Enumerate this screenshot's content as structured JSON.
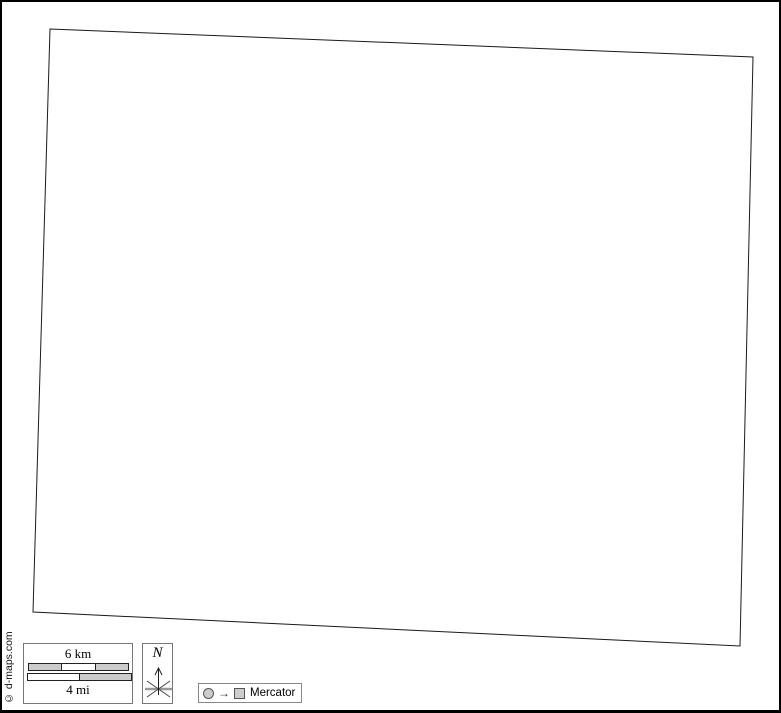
{
  "map": {
    "description": "blank map outline",
    "fill": "#ffffff",
    "stroke": "#1a1a1a",
    "corners": [
      [
        50,
        29
      ],
      [
        753,
        57
      ],
      [
        740,
        646
      ],
      [
        33,
        612
      ]
    ]
  },
  "scale_bar": {
    "km_label": "6 km",
    "mi_label": "4 mi",
    "km_segments": [
      "#cccccc",
      "#ffffff",
      "#cccccc"
    ],
    "mi_segments": [
      "#ffffff",
      "#cccccc"
    ]
  },
  "compass": {
    "north_label": "N"
  },
  "projection": {
    "arrow_glyph": "→",
    "label": "Mercator"
  },
  "copyright": "© d-maps.com"
}
